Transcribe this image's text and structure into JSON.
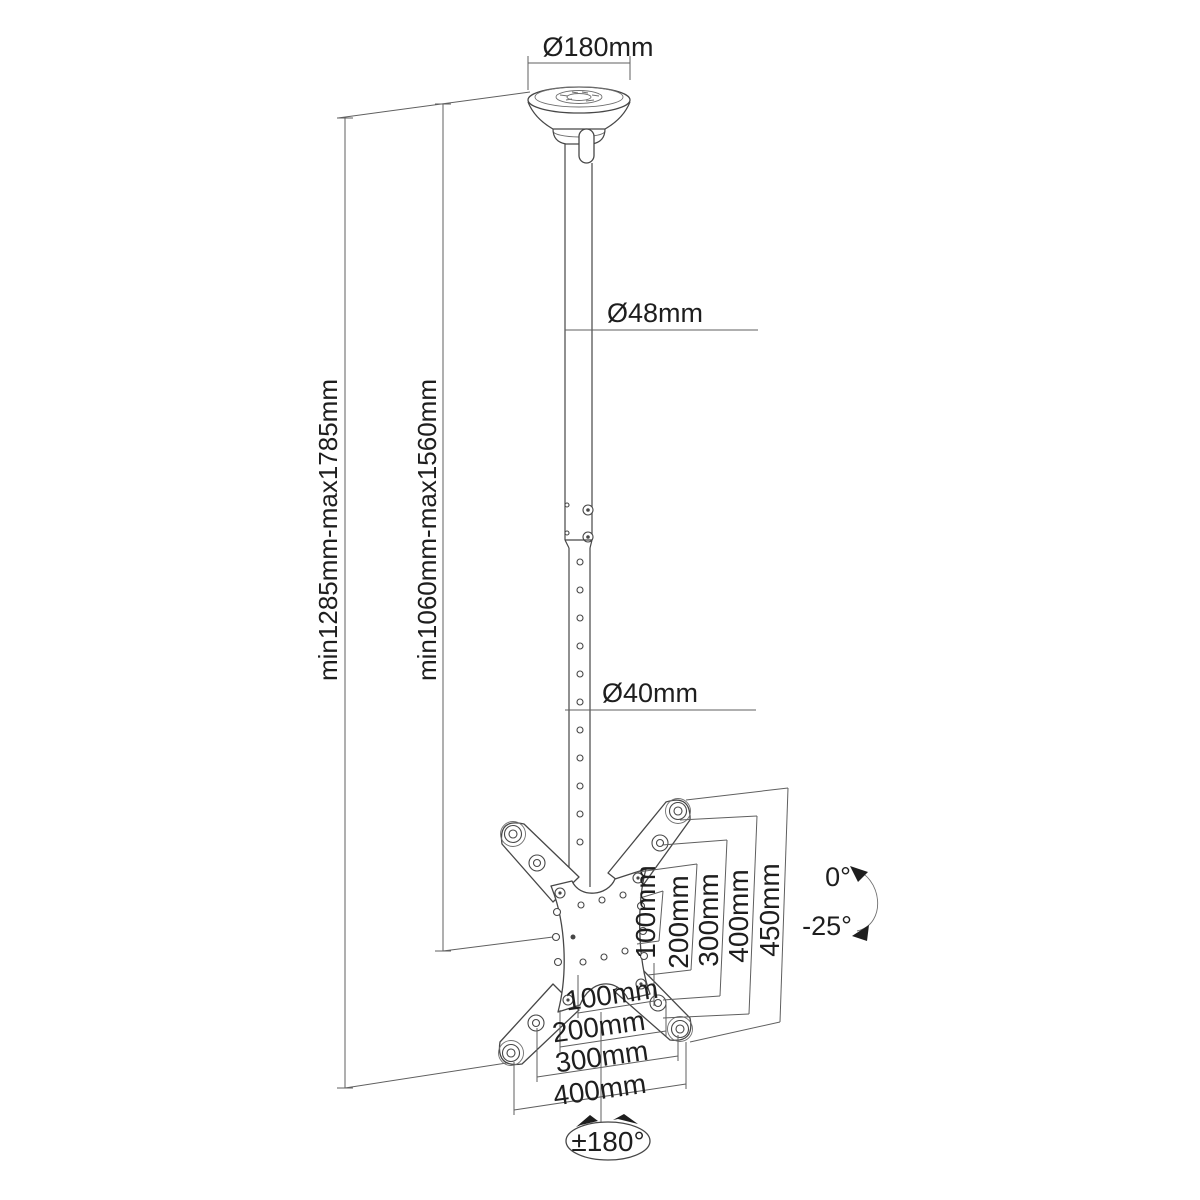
{
  "dimensions": {
    "ceiling_plate_diameter": "Ø180mm",
    "upper_tube_diameter": "Ø48mm",
    "inner_tube_diameter": "Ø40mm",
    "overall_height_range": "min1285mm-max1785mm",
    "tube_height_range": "min1060mm-max1560mm",
    "vesa_vertical": [
      "100mm",
      "200mm",
      "300mm",
      "400mm",
      "450mm"
    ],
    "vesa_horizontal": [
      "100mm",
      "200mm",
      "300mm",
      "400mm"
    ],
    "tilt_max": "0°",
    "tilt_min": "-25°",
    "rotation_range": "±180°"
  },
  "style_colors": {
    "background": "#ffffff",
    "line": "#5f5f5f",
    "part_outline": "#474747",
    "text": "#1e1e1e"
  }
}
